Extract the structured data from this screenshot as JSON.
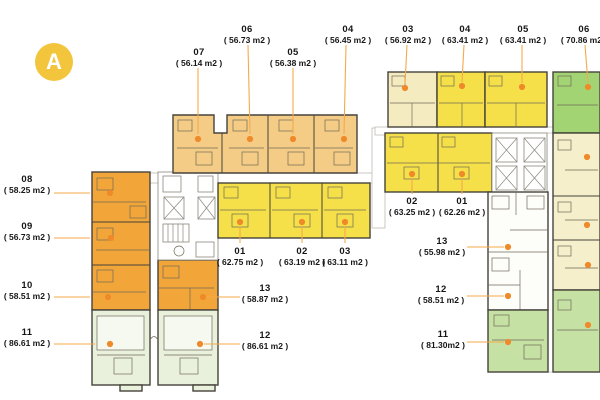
{
  "badge": {
    "letter": "A"
  },
  "colors": {
    "badge": "#f2c53d",
    "callout_line": "#f5a94b",
    "dot": "#ef8a2b",
    "orange": "#f2a63a",
    "tan": "#f5cc85",
    "yellow": "#f6e049",
    "cream": "#f5ebc0",
    "pale_cream": "#f5efcb",
    "green_bright": "#a3d473",
    "green_mid": "#c5e1a4",
    "green_pale": "#e9f1dc",
    "white_unit": "#fdfdfa",
    "wall": "#46433b"
  },
  "units": [
    {
      "number": "06",
      "area": "( 56.73 m2 )",
      "label": [
        247,
        24
      ],
      "line": [
        248,
        45,
        250,
        134
      ],
      "dot": [
        250,
        139
      ]
    },
    {
      "number": "07",
      "area": "( 56.14 m2 )",
      "label": [
        199,
        47
      ],
      "line": [
        198,
        68,
        198,
        134
      ],
      "dot": [
        198,
        139
      ]
    },
    {
      "number": "05",
      "area": "( 56.38 m2 )",
      "label": [
        293,
        47
      ],
      "line": [
        293,
        68,
        293,
        134
      ],
      "dot": [
        293,
        139
      ]
    },
    {
      "number": "04",
      "area": "( 56.45 m2 )",
      "label": [
        348,
        24
      ],
      "line": [
        346,
        45,
        344,
        134
      ],
      "dot": [
        344,
        139
      ]
    },
    {
      "number": "03",
      "area": "( 56.92 m2 )",
      "label": [
        408,
        24
      ],
      "line": [
        407,
        45,
        405,
        84
      ],
      "dot": [
        405,
        88
      ]
    },
    {
      "number": "04",
      "area": "( 63.41 m2 )",
      "label": [
        465,
        24
      ],
      "line": [
        464,
        45,
        462,
        82
      ],
      "dot": [
        462,
        86
      ]
    },
    {
      "number": "05",
      "area": "( 63.41 m2 )",
      "label": [
        523,
        24
      ],
      "line": [
        522,
        45,
        522,
        83
      ],
      "dot": [
        522,
        87
      ]
    },
    {
      "number": "06",
      "area": "( 70.86 m2 )",
      "label": [
        584,
        24
      ],
      "line": [
        585,
        45,
        588,
        83
      ],
      "dot": [
        588,
        87
      ]
    },
    {
      "number": "08",
      "area": "( 58.25 m2 )",
      "label": [
        27,
        174
      ],
      "line": [
        54,
        193,
        90,
        193
      ],
      "dot": [
        110,
        193
      ]
    },
    {
      "number": "09",
      "area": "( 56.73 m2 )",
      "label": [
        27,
        221
      ],
      "line": [
        54,
        238,
        90,
        238
      ],
      "dot": [
        111,
        238
      ]
    },
    {
      "number": "10",
      "area": "( 58.51 m2 )",
      "label": [
        27,
        280
      ],
      "line": [
        54,
        297,
        90,
        297
      ],
      "dot": [
        108,
        297
      ]
    },
    {
      "number": "11",
      "area": "( 86.61 m2 )",
      "label": [
        27,
        327
      ],
      "line": [
        54,
        344,
        95,
        344
      ],
      "dot": [
        110,
        344
      ]
    },
    {
      "number": "01",
      "area": "( 62.75 m2 )",
      "label": [
        240,
        246
      ],
      "line": [
        240,
        226,
        240,
        243
      ],
      "dot": [
        240,
        222
      ]
    },
    {
      "number": "02",
      "area": "( 63.19 m2 )",
      "label": [
        302,
        246
      ],
      "line": [
        302,
        226,
        302,
        243
      ],
      "dot": [
        302,
        222
      ]
    },
    {
      "number": "03",
      "area": "( 63.11 m2 )",
      "label": [
        345,
        246
      ],
      "line": [
        345,
        226,
        345,
        243
      ],
      "dot": [
        345,
        222
      ]
    },
    {
      "number": "13",
      "area": "( 58.87 m2 )",
      "label": [
        265,
        283
      ],
      "line": [
        207,
        297,
        240,
        297
      ],
      "dot": [
        203,
        297
      ]
    },
    {
      "number": "12",
      "area": "( 86.61 m2 )",
      "label": [
        265,
        330
      ],
      "line": [
        204,
        344,
        240,
        344
      ],
      "dot": [
        200,
        344
      ]
    },
    {
      "number": "02",
      "area": "( 63.25 m2 )",
      "label": [
        412,
        196
      ],
      "line": [
        412,
        178,
        412,
        194
      ],
      "dot": [
        412,
        174
      ]
    },
    {
      "number": "01",
      "area": "( 62.26 m2 )",
      "label": [
        462,
        196
      ],
      "line": [
        462,
        178,
        462,
        194
      ],
      "dot": [
        462,
        174
      ]
    },
    {
      "number": "13",
      "area": "( 55.98 m2 )",
      "label": [
        442,
        236
      ],
      "line": [
        467,
        247,
        504,
        247
      ],
      "dot": [
        508,
        247
      ]
    },
    {
      "number": "12",
      "area": "( 58.51 m2 )",
      "label": [
        441,
        284
      ],
      "line": [
        467,
        296,
        504,
        296
      ],
      "dot": [
        508,
        296
      ]
    },
    {
      "number": "11",
      "area": "( 81.30m2 )",
      "label": [
        443,
        329
      ],
      "line": [
        467,
        342,
        504,
        342
      ],
      "dot": [
        508,
        342
      ]
    }
  ],
  "extra_dots": [
    [
      587,
      157
    ],
    [
      587,
      225
    ],
    [
      588,
      265
    ],
    [
      588,
      325
    ]
  ]
}
